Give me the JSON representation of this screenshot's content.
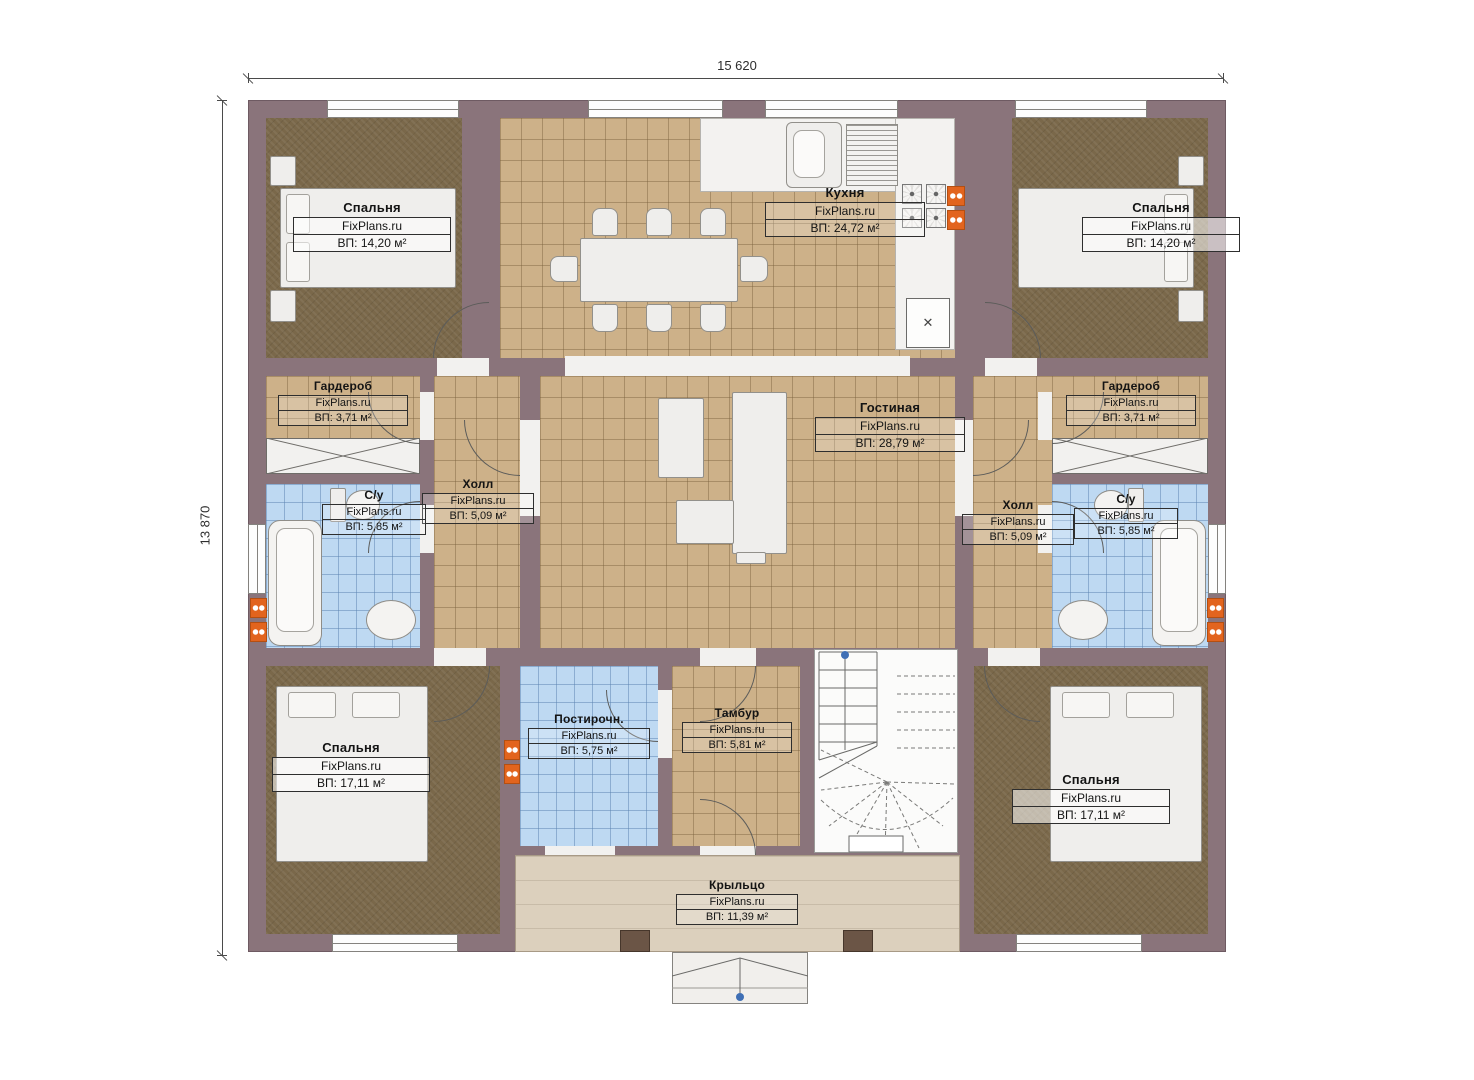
{
  "dimensions": {
    "top": "15 620",
    "left": "13 870"
  },
  "rooms": {
    "bedroom_tl": {
      "name": "Спальня",
      "brand": "FixPlans.ru",
      "area": "ВП: 14,20 м²"
    },
    "bedroom_tr": {
      "name": "Спальня",
      "brand": "FixPlans.ru",
      "area": "ВП: 14,20 м²"
    },
    "kitchen": {
      "name": "Кухня",
      "brand": "FixPlans.ru",
      "area": "ВП: 24,72 м²"
    },
    "living": {
      "name": "Гостиная",
      "brand": "FixPlans.ru",
      "area": "ВП: 28,79 м²"
    },
    "wardrobe_l": {
      "name": "Гардероб",
      "brand": "FixPlans.ru",
      "area": "ВП: 3,71 м²"
    },
    "wardrobe_r": {
      "name": "Гардероб",
      "brand": "FixPlans.ru",
      "area": "ВП: 3,71 м²"
    },
    "hall_l": {
      "name": "Холл",
      "brand": "FixPlans.ru",
      "area": "ВП: 5,09 м²"
    },
    "hall_r": {
      "name": "Холл",
      "brand": "FixPlans.ru",
      "area": "ВП: 5,09 м²"
    },
    "bath_l": {
      "name": "С/у",
      "brand": "FixPlans.ru",
      "area": "ВП: 5,85 м²"
    },
    "bath_r": {
      "name": "С/у",
      "brand": "FixPlans.ru",
      "area": "ВП: 5,85 м²"
    },
    "bedroom_bl": {
      "name": "Спальня",
      "brand": "FixPlans.ru",
      "area": "ВП: 17,11 м²"
    },
    "bedroom_br": {
      "name": "Спальня",
      "brand": "FixPlans.ru",
      "area": "ВП: 17,11 м²"
    },
    "laundry": {
      "name": "Постирочн.",
      "brand": "FixPlans.ru",
      "area": "ВП: 5,75 м²"
    },
    "vestibule": {
      "name": "Тамбур",
      "brand": "FixPlans.ru",
      "area": "ВП: 5,81 м²"
    },
    "porch": {
      "name": "Крыльцо",
      "brand": "FixPlans.ru",
      "area": "ВП: 11,39 м²"
    }
  },
  "icons": {
    "fridge_mark": "✕"
  },
  "colors": {
    "wall": "#8a747b",
    "tile": "#cdb189",
    "wet_tile": "#bed9f2",
    "carpet": "#7a684a",
    "porch": "#dcd0bd",
    "radiator": "#e2641e",
    "marker": "#3f6fb5"
  }
}
